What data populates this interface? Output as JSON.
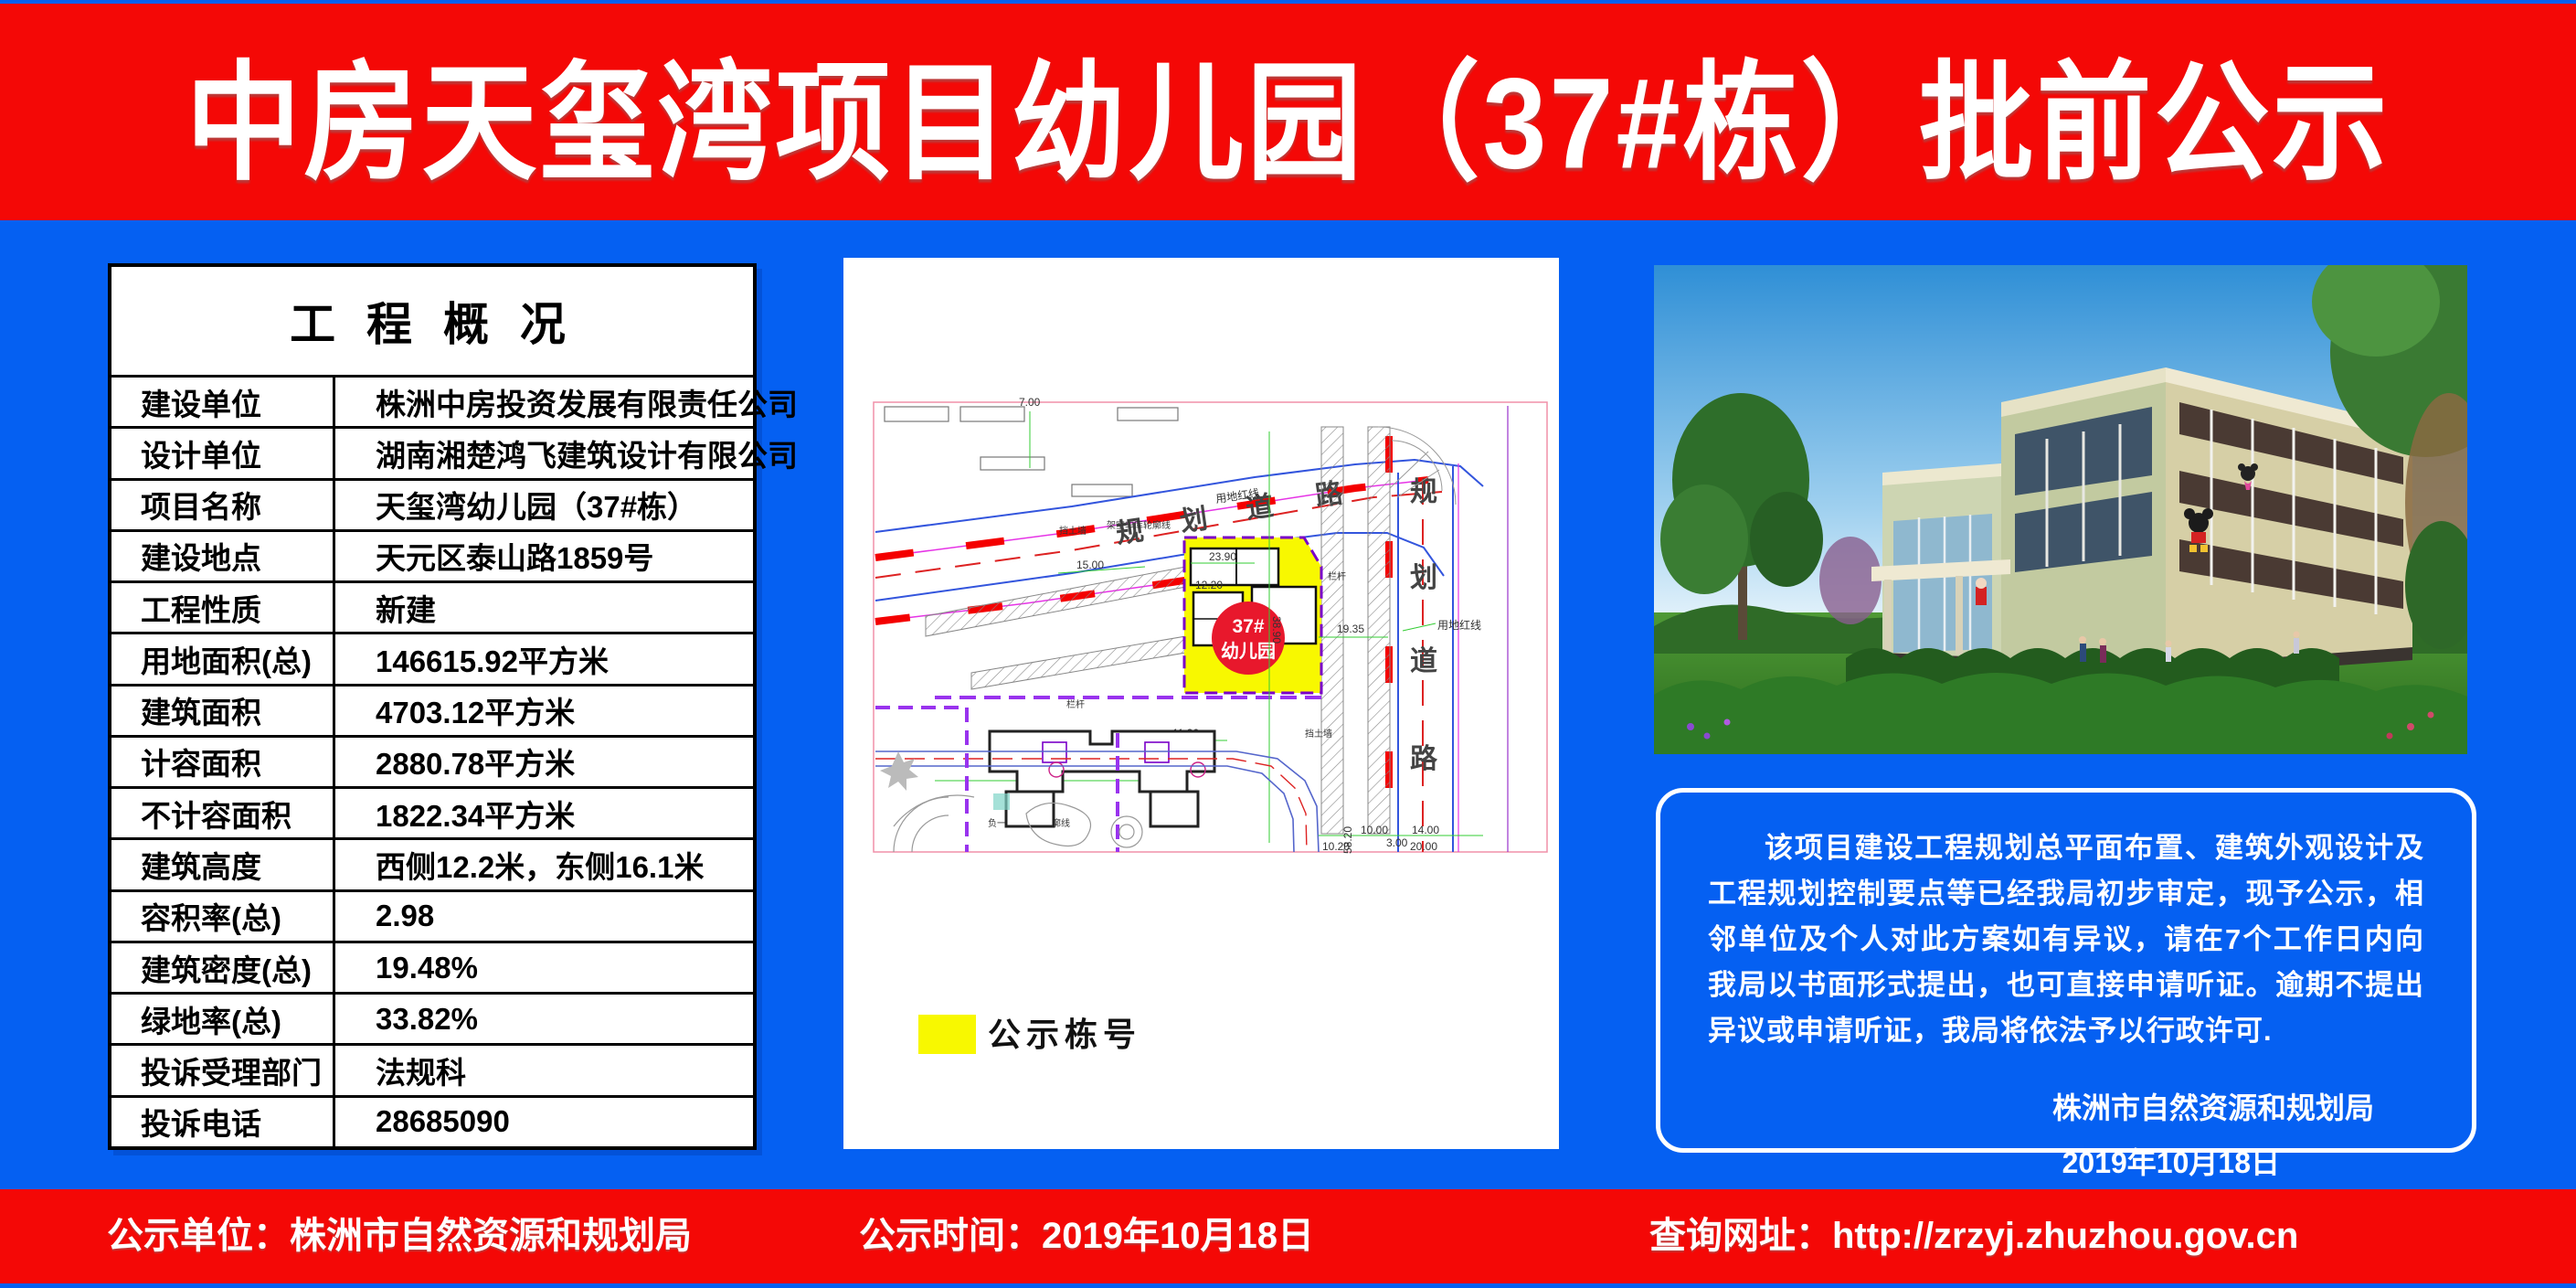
{
  "header": {
    "title": "中房天玺湾项目幼儿园（37#栋）批前公示"
  },
  "overview_table": {
    "title": "工 程 概 况",
    "rows": [
      {
        "label": "建设单位",
        "value": "株洲中房投资发展有限责任公司"
      },
      {
        "label": "设计单位",
        "value": "湖南湘楚鸿飞建筑设计有限公司"
      },
      {
        "label": "项目名称",
        "value": "天玺湾幼儿园（37#栋）"
      },
      {
        "label": "建设地点",
        "value": "天元区泰山路1859号"
      },
      {
        "label": "工程性质",
        "value": "新建"
      },
      {
        "label": "用地面积(总)",
        "value": "146615.92平方米"
      },
      {
        "label": "建筑面积",
        "value": "4703.12平方米"
      },
      {
        "label": "计容面积",
        "value": "2880.78平方米"
      },
      {
        "label": "不计容面积",
        "value": "1822.34平方米"
      },
      {
        "label": "建筑高度",
        "value": "西侧12.2米，东侧16.1米"
      },
      {
        "label": "容积率(总)",
        "value": "2.98"
      },
      {
        "label": "建筑密度(总)",
        "value": "19.48%"
      },
      {
        "label": "绿地率(总)",
        "value": "33.82%"
      },
      {
        "label": "投诉受理部门",
        "value": "法规科"
      },
      {
        "label": "投诉电话",
        "value": "28685090"
      }
    ]
  },
  "site_plan": {
    "road_top": [
      "规",
      "划",
      "道",
      "路"
    ],
    "road_right": [
      "规",
      "划",
      "道",
      "路"
    ],
    "building_no": "37#",
    "building_name": "幼儿园",
    "legend_label": "公示栋号",
    "red_line_label": "用地红线",
    "red_line_label2": "用地红线",
    "retaining_wall_label": "挡土墙",
    "retaining_wall_label2": "挡土墙",
    "railing_label": "栏杆",
    "railing_label2": "栏杆",
    "garage_outline_label": "架空车库轮廓线",
    "basement_outline_label": "负一层地下室轮廓线",
    "dims": {
      "d1": "23.90",
      "d2": "12.20",
      "d3": "38.90",
      "d4": "19.35",
      "d5": "15.00",
      "d6": "58.05",
      "d7": "11.30",
      "d8": "10.20",
      "d9": "20.00",
      "d10": "14.00",
      "d11": "10.00",
      "d12": "3.00",
      "d13": "7.00",
      "d14": "58.20"
    }
  },
  "notice": {
    "body": "该项目建设工程规划总平面布置、建筑外观设计及工程规划控制要点等已经我局初步审定，现予公示，相邻单位及个人对此方案如有异议，请在7个工作日内向我局以书面形式提出，也可直接申请听证。逾期不提出异议或申请听证，我局将依法予以行政许可.",
    "signature": "株洲市自然资源和规划局",
    "date": "2019年10月18日"
  },
  "footer": {
    "unit": "公示单位：株洲市自然资源和规划局",
    "time": "公示时间：2019年10月18日",
    "site": "查询网址：http://zrzyj.zhuzhou.gov.cn"
  },
  "colors": {
    "banner_red": "#f40806",
    "body_blue": "#0560f2",
    "highlight_yellow": "#f8f800",
    "badge_red": "#e8182c"
  }
}
